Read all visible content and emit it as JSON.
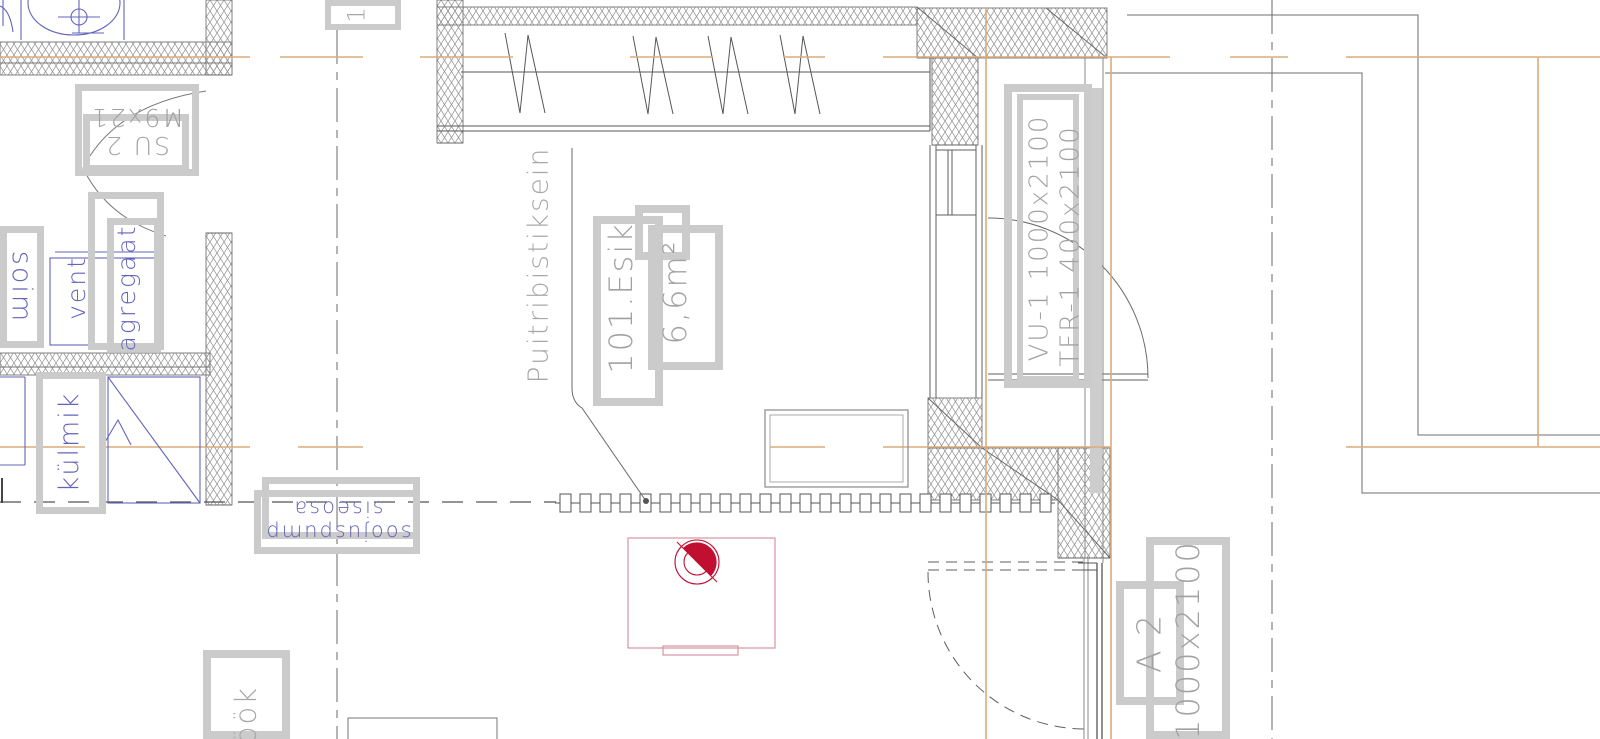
{
  "drawing": {
    "type": "architectural-floor-plan",
    "colors": {
      "background": "#ffffff",
      "line": "#5f5f5f",
      "hatch": "#8f8f8f",
      "axis_orange": "#dcab7c",
      "annotation_gray_box": "#cbcbcb",
      "annotation_gray_text": "#a2a2a2",
      "fixture_blue": "#6363bd",
      "equipment_red": "#c00f31",
      "equipment_pink": "#d795a2"
    },
    "labels": {
      "grid_bubble": "1",
      "door_su2_line1": "SU 2",
      "door_su2_line2": "M9x21",
      "vent_line1": "vent",
      "vent_line2": "agregaat",
      "soim": "soim",
      "fridge": "külmik",
      "heatpump_line1": "soojuspump",
      "heatpump_line2": "siseosa",
      "kitchen": "köök",
      "partition_wall": "Puitribistiksein",
      "room_number": "101.Esik",
      "room_area": "6,6m²",
      "door_vu1": "VU-1 1000x2100",
      "window_tfr1": "TFR-1 400x2100",
      "door_a2_code": "A 2",
      "door_a2_size": "1000x2100"
    }
  }
}
